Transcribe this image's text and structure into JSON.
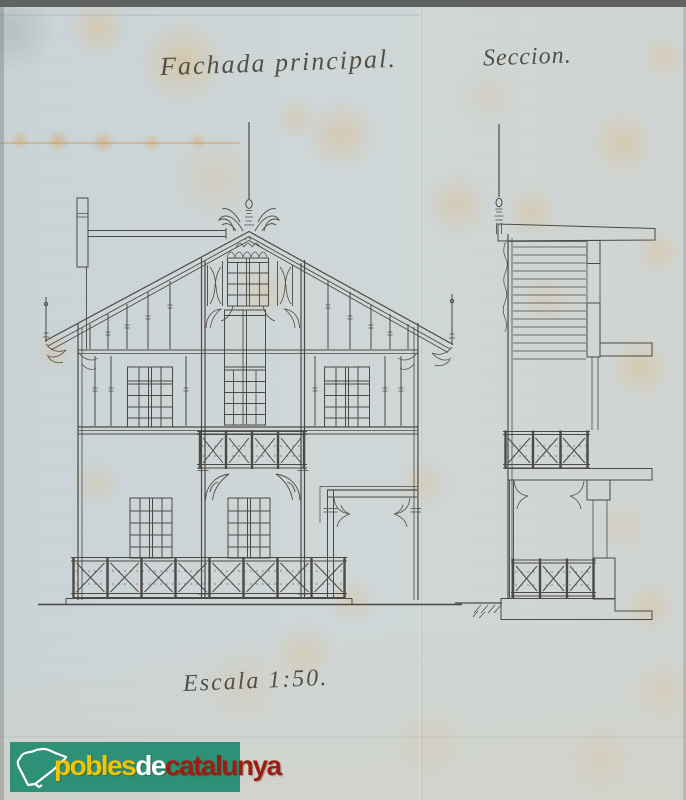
{
  "sheet": {
    "titles": {
      "facade": "Fachada principal.",
      "section": "Seccion.",
      "scale": "Escala 1:50."
    },
    "watermark": {
      "word1": "pobles",
      "word2": "de",
      "word3": "catalunya",
      "map_icon": "catalonia-map-icon"
    },
    "colors": {
      "paper": "#cdd6d8",
      "ink": "#45413a",
      "wash_pink": "#eca3ab",
      "wash_pink_edge": "#9c4a52",
      "logo_green": "#2e9077",
      "logo_yellow": "#f3c402",
      "logo_text_white": "#ffffff",
      "logo_red": "#9e1d10"
    }
  }
}
